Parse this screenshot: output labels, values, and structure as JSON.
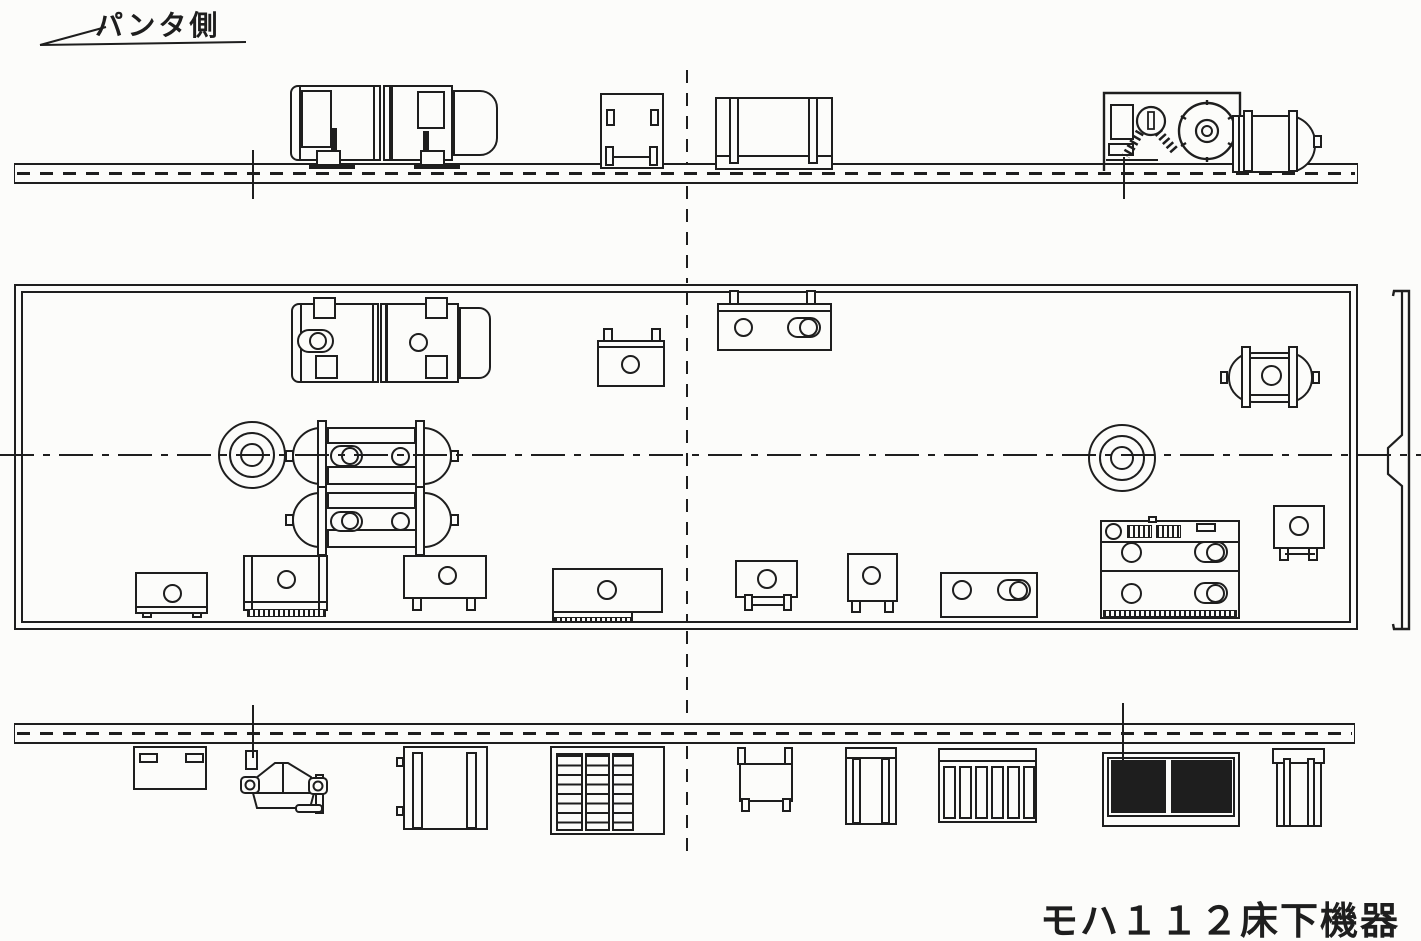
{
  "drawing": {
    "side_label": "パンタ側",
    "title": "モハ１１２床下機器"
  },
  "colors": {
    "ink": "#1e1e1e",
    "paper": "#fcfcfa"
  }
}
